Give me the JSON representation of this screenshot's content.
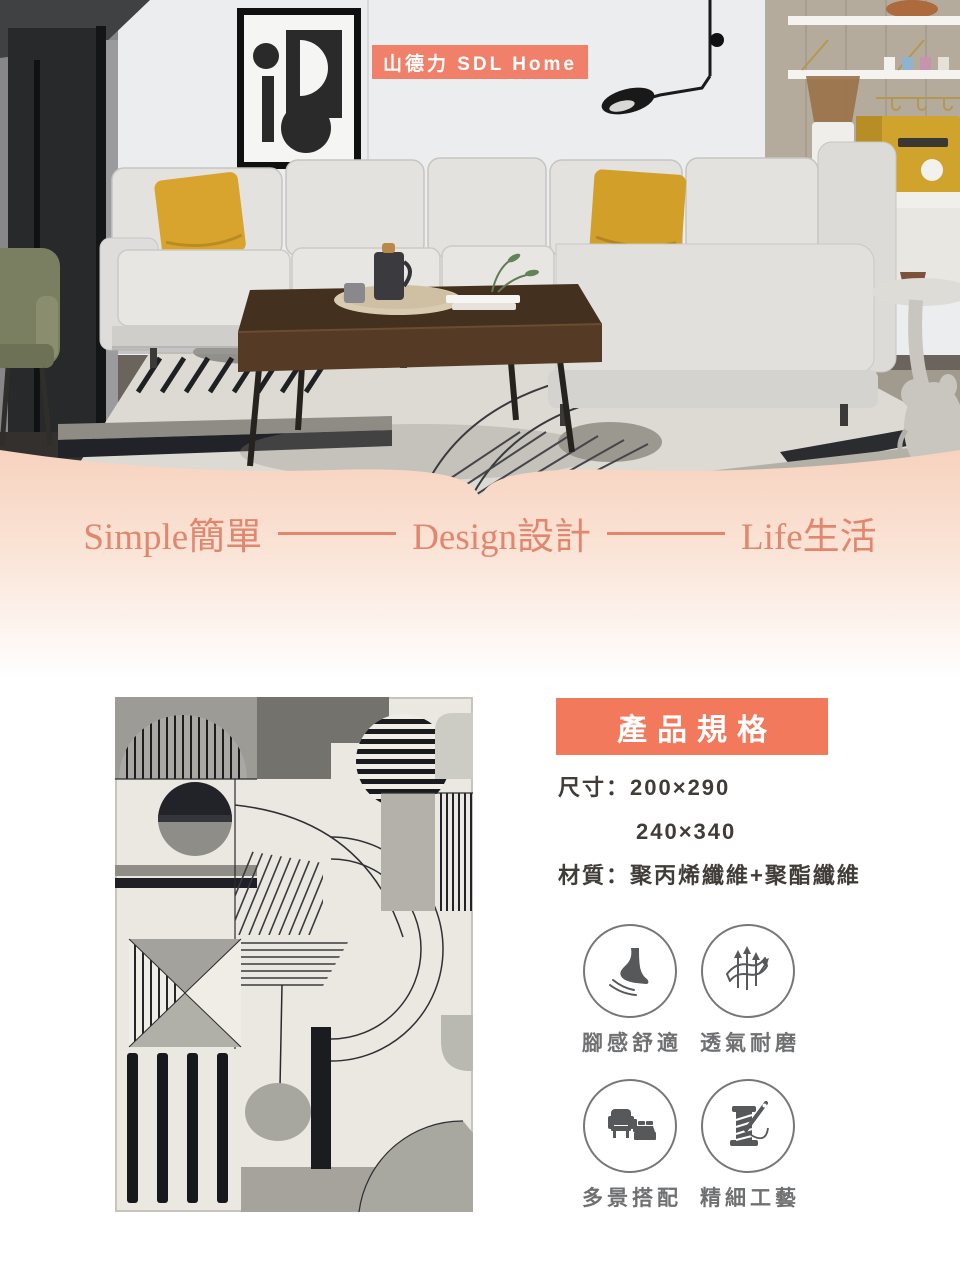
{
  "brand": {
    "badge_label": "山德力 SDL Home"
  },
  "tagline": {
    "segments": [
      {
        "en": "Simple",
        "zh": "簡單"
      },
      {
        "en": "Design",
        "zh": "設計"
      },
      {
        "en": "Life",
        "zh": "生活"
      }
    ]
  },
  "specs_panel": {
    "title": "產品規格",
    "size_label": "尺寸：",
    "size_value_1": "200×290",
    "size_value_2": "240×340",
    "material_label": "材質：",
    "material_value": "聚丙烯纖維+聚酯纖維",
    "features": [
      {
        "icon": "foot-comfort-icon",
        "label": "腳感舒適"
      },
      {
        "icon": "breathable-durable-icon",
        "label": "透氣耐磨"
      },
      {
        "icon": "multi-scene-icon",
        "label": "多景搭配"
      },
      {
        "icon": "craftsmanship-icon",
        "label": "精細工藝"
      }
    ]
  },
  "colors": {
    "coral_banner": "#f2795c",
    "coral_badge": "#f0806a",
    "tagline_coral": "#e2876f",
    "peach_wave_top": "#f7d2bf",
    "mustard_pillow": "#d2a02c",
    "icon_gray": "#57585a",
    "label_gray": "#6f7072"
  }
}
